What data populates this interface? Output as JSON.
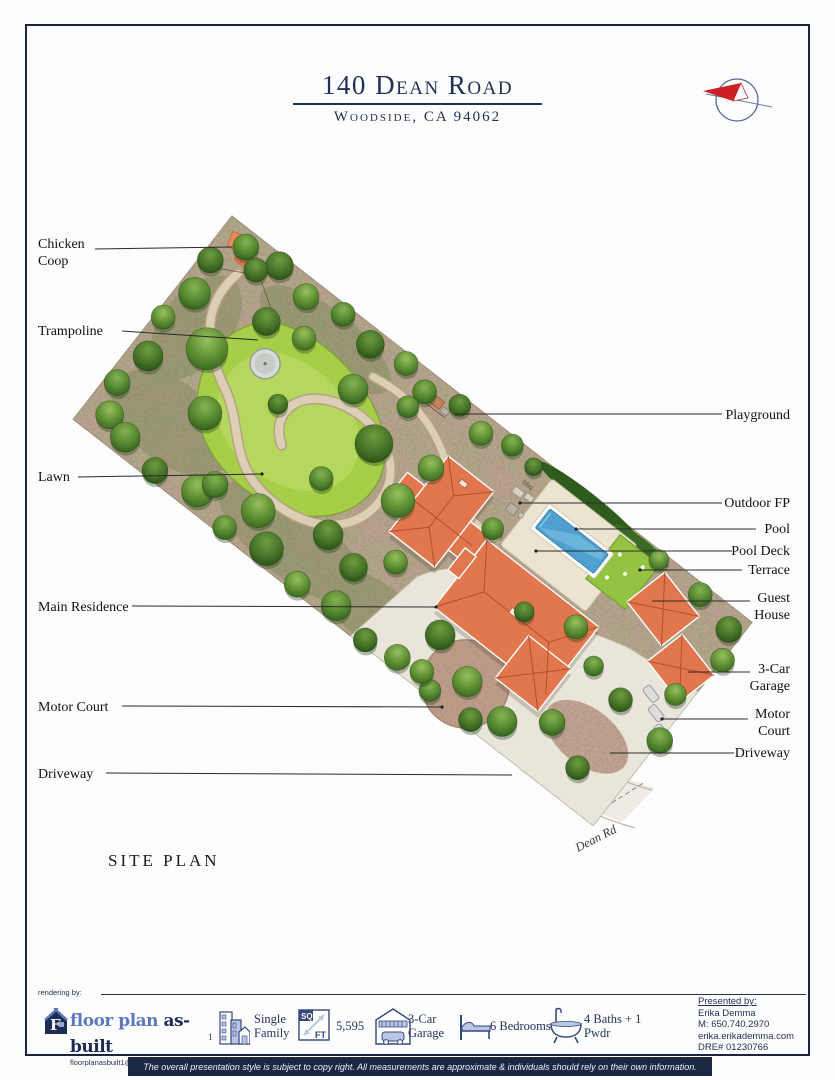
{
  "header": {
    "title": "140 Dean Road",
    "subtitle": "Woodside, CA 94062"
  },
  "plan": {
    "caption": "SITE PLAN",
    "street": "Dean Rd",
    "bbq": "bbq",
    "labels_left": [
      {
        "text": "Chicken Coop"
      },
      {
        "text": "Trampoline"
      },
      {
        "text": "Lawn"
      },
      {
        "text": "Main Residence"
      },
      {
        "text": "Motor Court"
      },
      {
        "text": "Driveway"
      }
    ],
    "labels_right": [
      {
        "text": "Playground"
      },
      {
        "text": "Outdoor FP"
      },
      {
        "text": "Pool"
      },
      {
        "text": "Pool Deck"
      },
      {
        "text": "Terrace"
      },
      {
        "text": "Guest House"
      },
      {
        "text": "3-Car Garage"
      },
      {
        "text": "Motor Court"
      },
      {
        "text": "Driveway"
      }
    ]
  },
  "footer": {
    "rendering_by": "rendering by:",
    "logo": {
      "monogram": "F",
      "brand_part1": "floor plan",
      "brand_part2": " as-built",
      "email": "floorplanasbuilt1@gmail.com"
    },
    "stats": [
      {
        "prefix": "1",
        "label": "Single Family"
      },
      {
        "sq": "SQ",
        "ft": "FT",
        "label": "5,595"
      },
      {
        "label": "3-Car Garage"
      },
      {
        "label": "6 Bedrooms"
      },
      {
        "label": "4 Baths + 1 Pwdr"
      }
    ],
    "presented_by": {
      "heading": "Presented by:",
      "name": "Erika Demma",
      "phone": "M: 650.740.2970",
      "website": "erika.erikademma.com",
      "dre": "DRE# 01230766"
    }
  },
  "disclaimer": "The overall presentation style is subject to copy right. All measurements are approximate & individuals should rely on their own information.",
  "colors": {
    "navy": "#1b2440",
    "title_navy": "#1d3254",
    "roof_coral": "#e2774e",
    "pool_blue": "#4fa0d0",
    "lawn_green": "#a6ce48",
    "ground_taupe": "#c3a695",
    "compass_red": "#cc2027"
  }
}
